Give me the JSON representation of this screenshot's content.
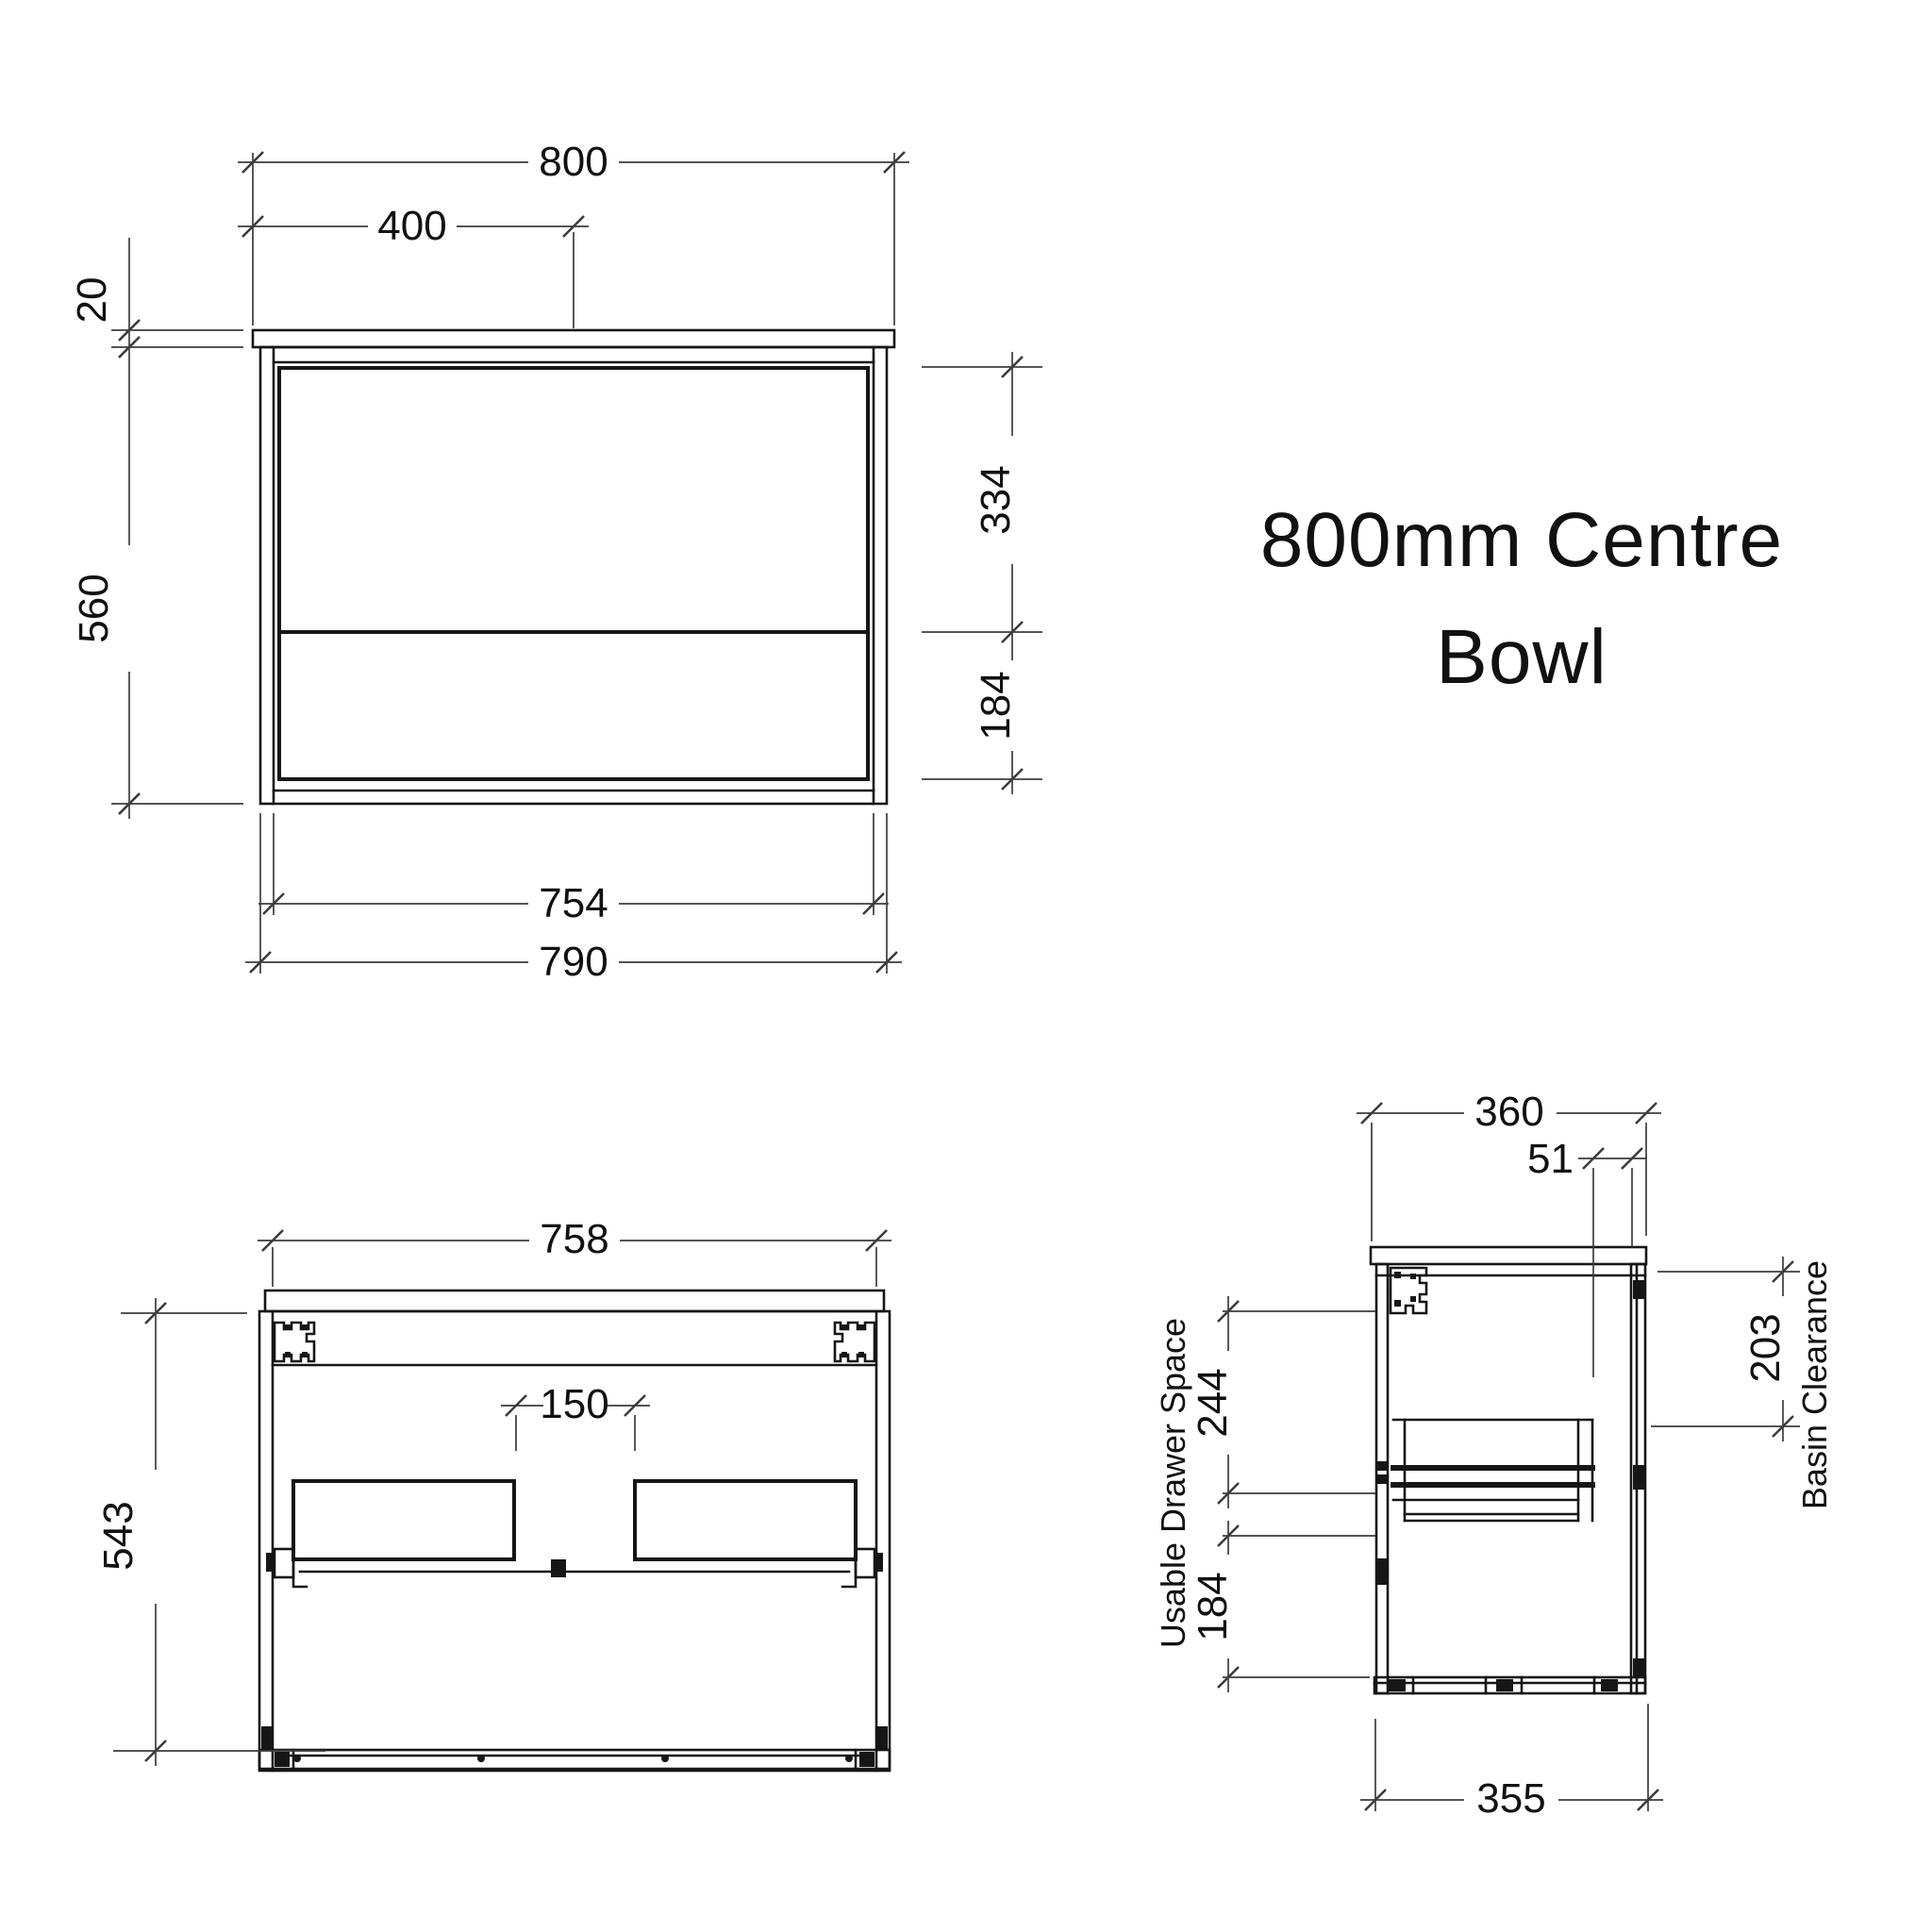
{
  "title": {
    "line1": "800mm Centre",
    "line2": "Bowl"
  },
  "front_view": {
    "dim_overall_width": "800",
    "dim_centre": "400",
    "dim_benchtop_thickness": "20",
    "dim_height": "560",
    "dim_top_drawer": "334",
    "dim_bottom_drawer": "184",
    "dim_internal_width": "754",
    "dim_carcass_width": "790"
  },
  "internal_view": {
    "dim_internal_width": "758",
    "dim_height": "543",
    "dim_centre_gap": "150"
  },
  "side_view": {
    "dim_depth": "360",
    "dim_waste_offset": "51",
    "dim_basin_clearance": "203",
    "label_basin_clearance": "Basin Clearance",
    "dim_usable_drawer": "244",
    "dim_lower_space": "184",
    "label_usable_drawer": "Usable Drawer Space",
    "dim_bottom_depth": "355"
  },
  "colors": {
    "background": "#ffffff",
    "object_line": "#161616",
    "dimension_line": "#3c3c3c",
    "text": "#111111"
  }
}
